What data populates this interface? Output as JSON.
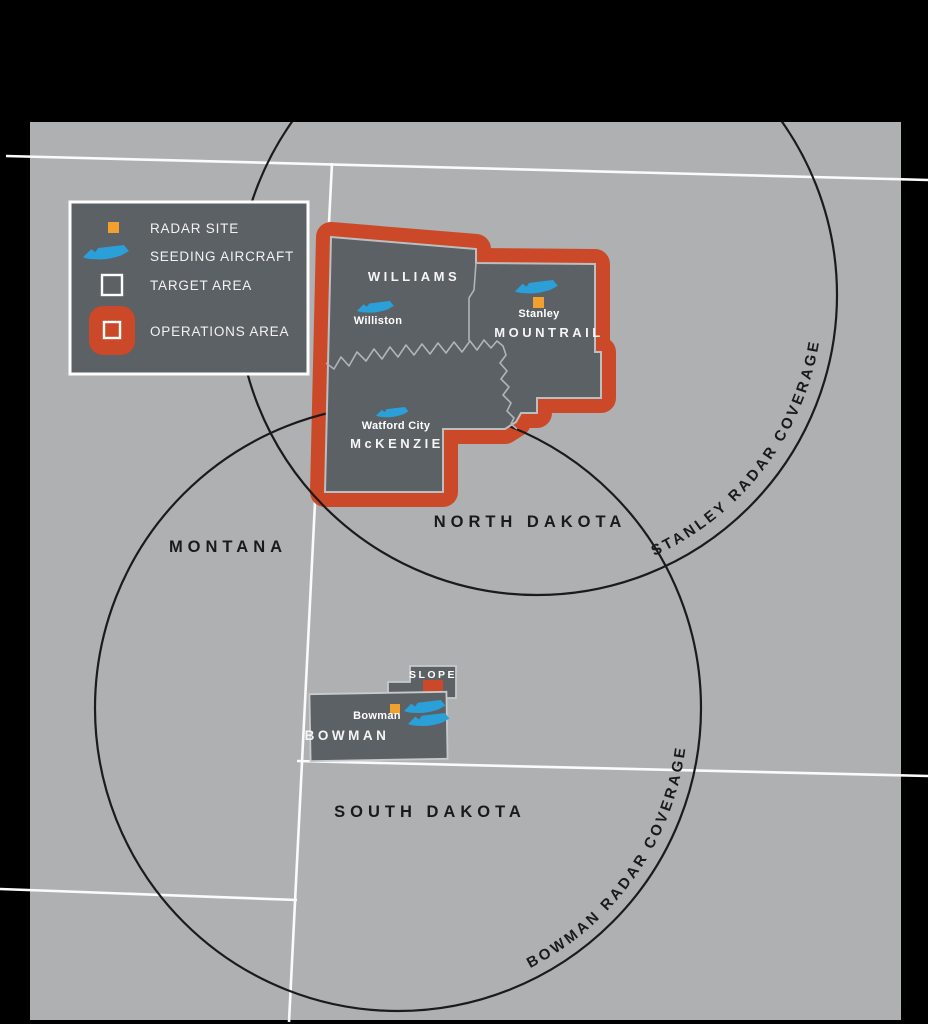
{
  "legend": {
    "items": [
      {
        "icon": "radar-site-square",
        "label": "RADAR SITE"
      },
      {
        "icon": "seeding-aircraft",
        "label": "SEEDING AIRCRAFT"
      },
      {
        "icon": "target-area-square",
        "label": "TARGET AREA"
      },
      {
        "icon": "operations-area-square",
        "label": "OPERATIONS AREA"
      }
    ]
  },
  "states": {
    "montana": "MONTANA",
    "north_dakota": "NORTH DAKOTA",
    "south_dakota": "SOUTH DAKOTA"
  },
  "counties": {
    "williams": "WILLIAMS",
    "mountrail": "MOUNTRAIL",
    "mckenzie": "McKENZIE",
    "bowman": "BOWMAN",
    "slope": "SLOPE"
  },
  "cities": {
    "williston": "Williston",
    "stanley": "Stanley",
    "watford_city": "Watford City",
    "bowman": "Bowman"
  },
  "radar_coverage": {
    "stanley": "STANLEY RADAR COVERAGE",
    "bowman": "BOWMAN RADAR COVERAGE"
  },
  "colors": {
    "outer_background": "#000000",
    "map_background": "#aeb0b2",
    "county_fill": "#5c6165",
    "operations_area_red": "#cb4928",
    "radar_site_orange": "#f2a12e",
    "aircraft_blue": "#2b9fd8",
    "state_border_white": "#fbfbfb",
    "coverage_circle": "#1b1b1b",
    "target_outline": "#bcbec0"
  }
}
